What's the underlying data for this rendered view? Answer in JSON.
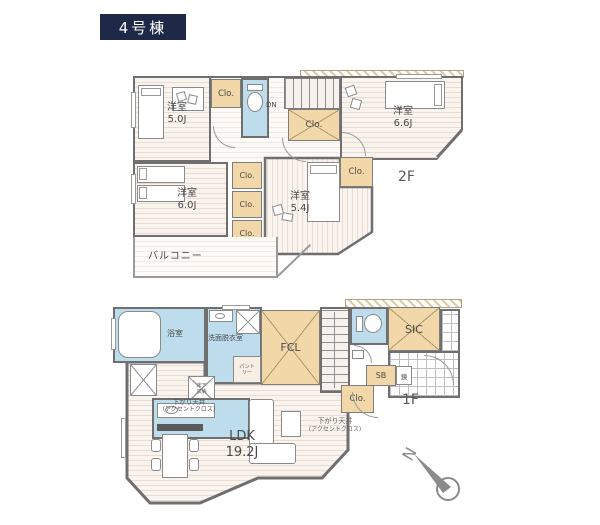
{
  "badge": {
    "text": "4号棟"
  },
  "floor2": {
    "label": "2F",
    "room_50": {
      "name": "洋室",
      "size": "5.0J"
    },
    "room_66": {
      "name": "洋室",
      "size": "6.6J"
    },
    "room_60": {
      "name": "洋室",
      "size": "6.0J"
    },
    "room_54": {
      "name": "洋室",
      "size": "5.4J"
    },
    "closet_top": "Clo.",
    "closet_hall": "Clo.",
    "closet_54": "Clo.",
    "closet_stack": [
      "Clo.",
      "Clo.",
      "Clo."
    ],
    "stairs_down": "DN",
    "balcony": "バルコニー"
  },
  "floor1": {
    "label": "1F",
    "bath": "浴室",
    "washroom": "洗面脱衣室",
    "pantry": "パントリー",
    "family_closet": "FCL",
    "shoes_in_closet": "SIC",
    "shoe_box": "SB",
    "mirror": "鏡",
    "closet": "Clo.",
    "underfloor_storage": "床下収納",
    "lowered_ceiling": "下がり天井",
    "lowered_ceiling_note": "(アクセントクロス)",
    "ldk": {
      "name": "LDK",
      "size": "19.2J"
    }
  },
  "compass": {
    "north": "N"
  },
  "colors": {
    "badge_bg": "#1e2947",
    "wall": "#6f6f6f",
    "closet": "#f2d8a9",
    "wet": "#bddded",
    "floor_bg": "#faf4ef",
    "floor_stripe": "#eadcd4",
    "label": "#4a4a4a",
    "compass": "#8a8a8a",
    "balcony_rail": "#9a9a9a"
  }
}
